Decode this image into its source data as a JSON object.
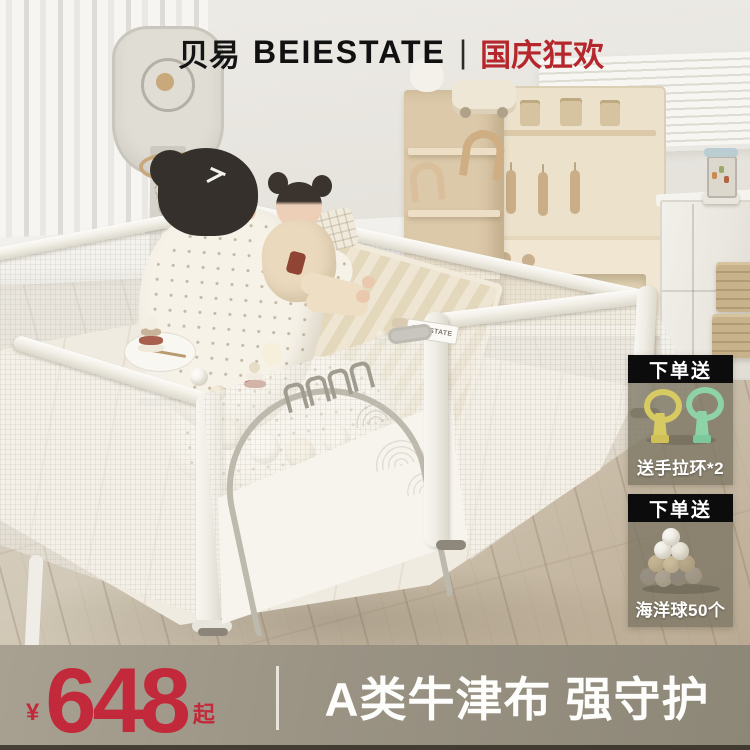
{
  "header": {
    "brand_cn": "贝易",
    "brand_en": "BEIESTATE",
    "divider": "|",
    "campaign": "国庆狂欢"
  },
  "badges": [
    {
      "header": "下单送",
      "caption": "送手拉环*2"
    },
    {
      "header": "下单送",
      "caption": "海洋球50个"
    }
  ],
  "playpen_tag": "BEIESTATE",
  "price_bar": {
    "currency": "¥",
    "amount": "648",
    "suffix": "起",
    "tagline": "A类牛津布 强守护"
  },
  "colors": {
    "accent_red": "#c2293a",
    "campaign_red": "#b5272d",
    "badge_header_bg": "#0c0c0c",
    "price_bar_bg": "#9a9384",
    "text_white": "#ffffff"
  }
}
